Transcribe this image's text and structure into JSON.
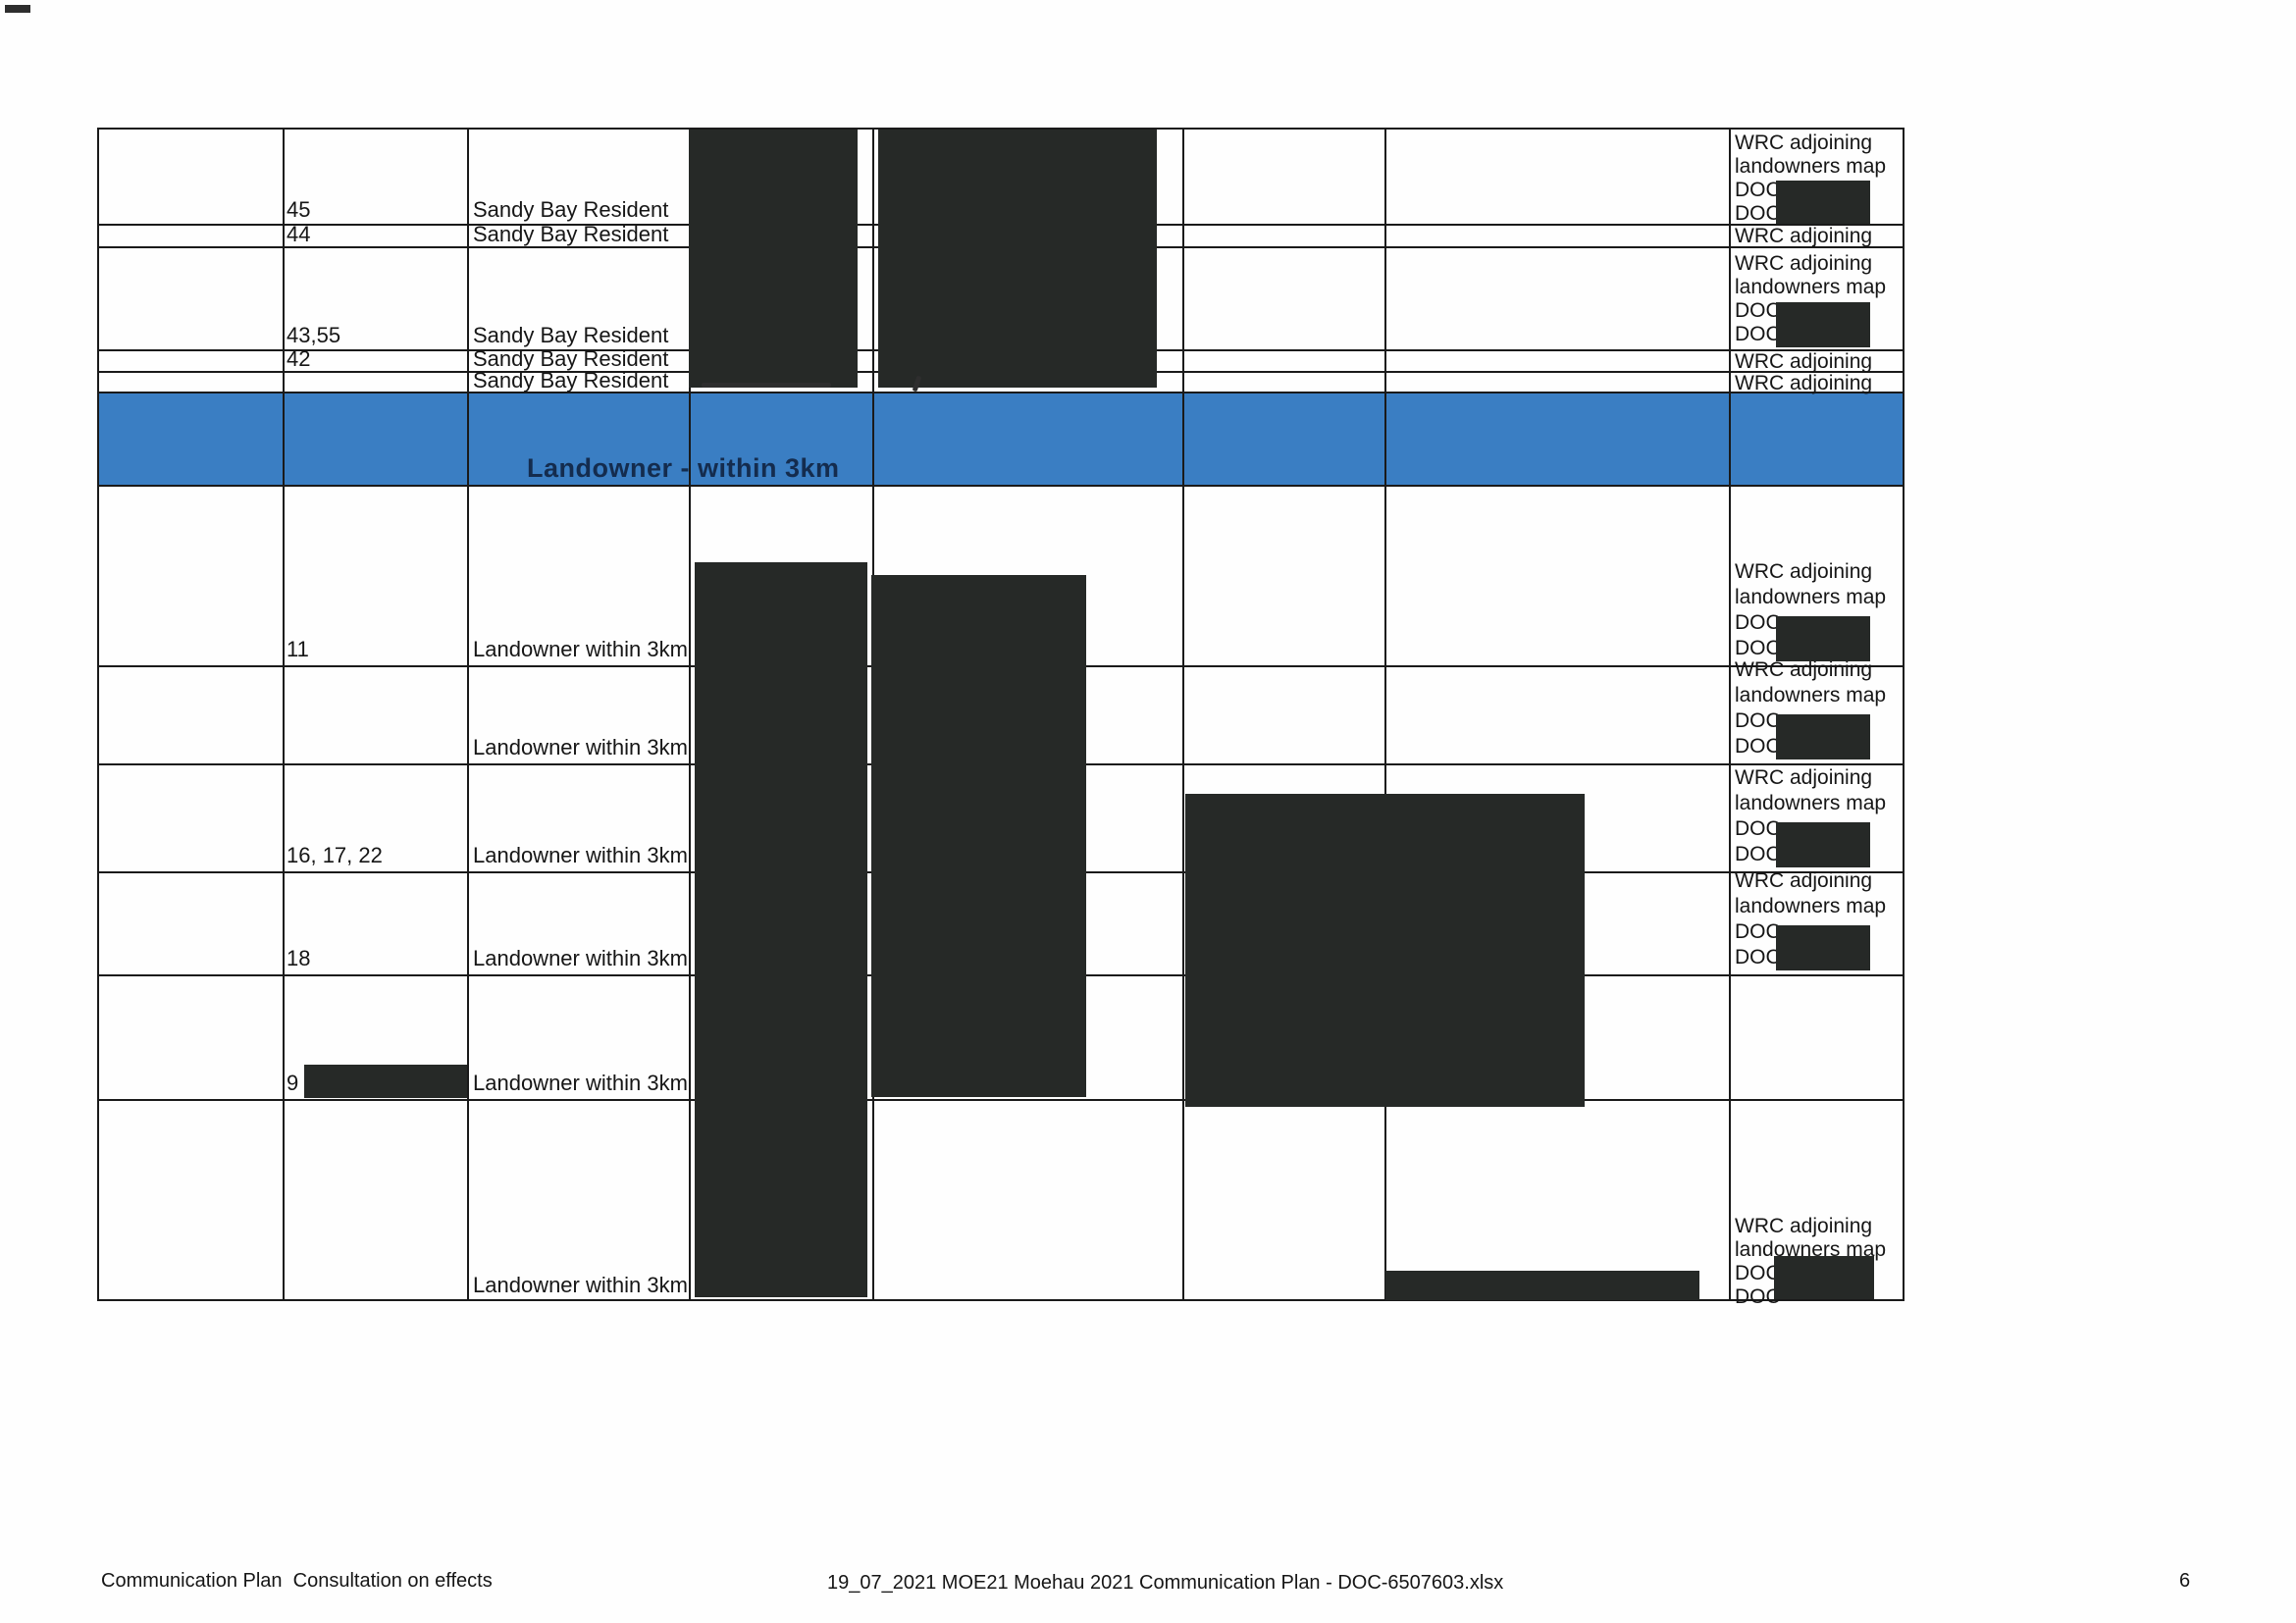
{
  "colors": {
    "ink": "#161616",
    "grid": "#1a1a1a",
    "redact": "#262927",
    "banner_blue": "#3a7ec3",
    "banner_text": "#142c4e",
    "paper": "#fefefe"
  },
  "banner": {
    "label": "Landowner - within 3km"
  },
  "labels": {
    "wrc_line1": "WRC adjoining",
    "wrc_line2": "landowners map",
    "doc": "DOC-",
    "doc_nodash": "DOC",
    "wrc_short": "WRC adjoining"
  },
  "rows": {
    "sandy_bay": [
      {
        "ids": "45",
        "name": "Sandy Bay Resident"
      },
      {
        "ids": "44",
        "name": "Sandy Bay Resident"
      },
      {
        "ids": "43,55",
        "name": "Sandy Bay Resident"
      },
      {
        "ids": "42",
        "name": "Sandy Bay Resident"
      },
      {
        "ids": "",
        "name": "Sandy Bay Resident"
      }
    ],
    "landowner": [
      {
        "ids": "11",
        "name": "Landowner within 3km"
      },
      {
        "ids": "",
        "name": "Landowner within 3km"
      },
      {
        "ids": "16, 17, 22",
        "name": "Landowner within 3km"
      },
      {
        "ids": "18",
        "name": "Landowner within 3km"
      },
      {
        "ids": "9",
        "name": "Landowner within 3km"
      },
      {
        "ids": "",
        "name": "Landowner within 3km"
      }
    ]
  },
  "footer": {
    "left": "Communication Plan  Consultation on effects",
    "center": "19_07_2021 MOE21 Moehau 2021 Communication Plan - DOC-6507603.xlsx",
    "page_number": "6"
  }
}
